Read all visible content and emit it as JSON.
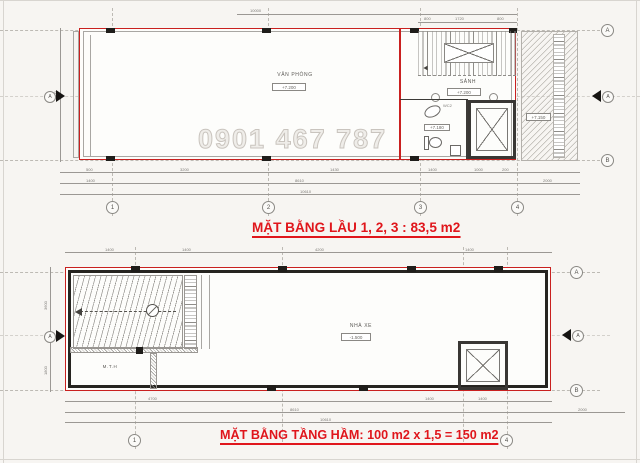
{
  "watermark": "0901 467 787",
  "upper": {
    "title": "MẶT BẰNG LẦU 1, 2, 3 : 83,5 m2",
    "office_label": "VĂN PHÒNG",
    "office_level": "+7.200",
    "lobby_label": "SẢNH",
    "lobby_level": "+7.200",
    "wc_label": "WC2",
    "wc_level": "+7.180",
    "neighbor_level": "+7.150",
    "grid_cols": [
      "1",
      "2",
      "3",
      "4"
    ],
    "grid_rows": [
      "A",
      "B"
    ],
    "section_label": "A",
    "dims": {
      "top_total": "10000",
      "stairs": [
        "800",
        "1720",
        "800"
      ],
      "row1": [
        "500",
        "3200",
        "1430",
        "1400",
        "1000",
        "200"
      ],
      "row2": [
        "1400",
        "8610",
        "2000"
      ],
      "row3": [
        "10610"
      ],
      "left": "3600"
    }
  },
  "lower": {
    "title": "MẶT BẰNG TẦNG HẦM: 100 m2 x 1,5 = 150 m2",
    "garage_label": "NHÀ XE",
    "garage_level": "-1.500",
    "room_label": "M.T.H",
    "grid_cols": [
      "1",
      "4"
    ],
    "grid_rows": [
      "A",
      "B"
    ],
    "section_label": "A",
    "dims": {
      "top": [
        "1400",
        "1400",
        "4200",
        "1400"
      ],
      "row1": [
        "4700",
        "1400",
        "1400"
      ],
      "row2": [
        "8610",
        "2000"
      ],
      "row3": [
        "10610"
      ],
      "left": [
        "3600",
        "1800"
      ]
    }
  }
}
